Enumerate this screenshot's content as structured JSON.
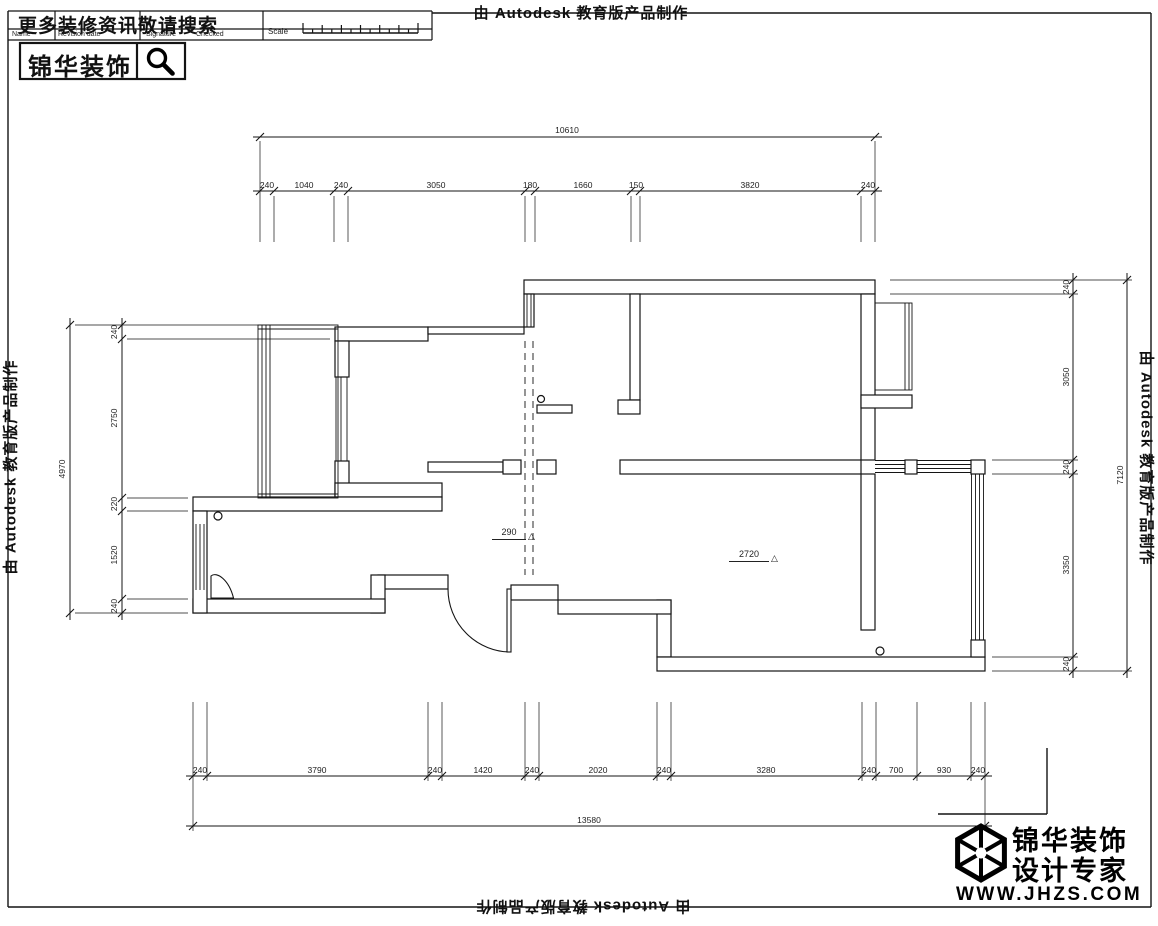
{
  "banners": {
    "edu_stamp": "由 Autodesk 教育版产品制作"
  },
  "title_block": {
    "headline": "更多装修资讯敬请搜索",
    "fields": {
      "name": "Name",
      "revision_date": "Revision date",
      "signature": "Signature",
      "checked": "Checked",
      "scale": "Scale"
    },
    "brand": "锦华装饰"
  },
  "brand_logo": {
    "name_line": "锦华装饰",
    "tagline": "设计专家",
    "website": "WWW.JHZS.COM"
  },
  "plan": {
    "level_marks": [
      {
        "value": "290",
        "symbol": "△"
      },
      {
        "value": "2720",
        "symbol": "△"
      }
    ],
    "dims": {
      "top": {
        "overall": "10610",
        "segments": [
          "240",
          "1040",
          "240",
          "3050",
          "180",
          "1660",
          "150",
          "3820",
          "240"
        ]
      },
      "bottom": {
        "overall": "13580",
        "segments": [
          "240",
          "3790",
          "240",
          "1420",
          "240",
          "2020",
          "240",
          "3280",
          "240",
          "700",
          "930",
          "240"
        ]
      },
      "left": {
        "overall": "4970",
        "segments": [
          "240",
          "2750",
          "220",
          "1520",
          "240"
        ]
      },
      "right": {
        "overall": "7120",
        "segments": [
          "240",
          "3050",
          "240",
          "3350",
          "240"
        ]
      }
    }
  }
}
